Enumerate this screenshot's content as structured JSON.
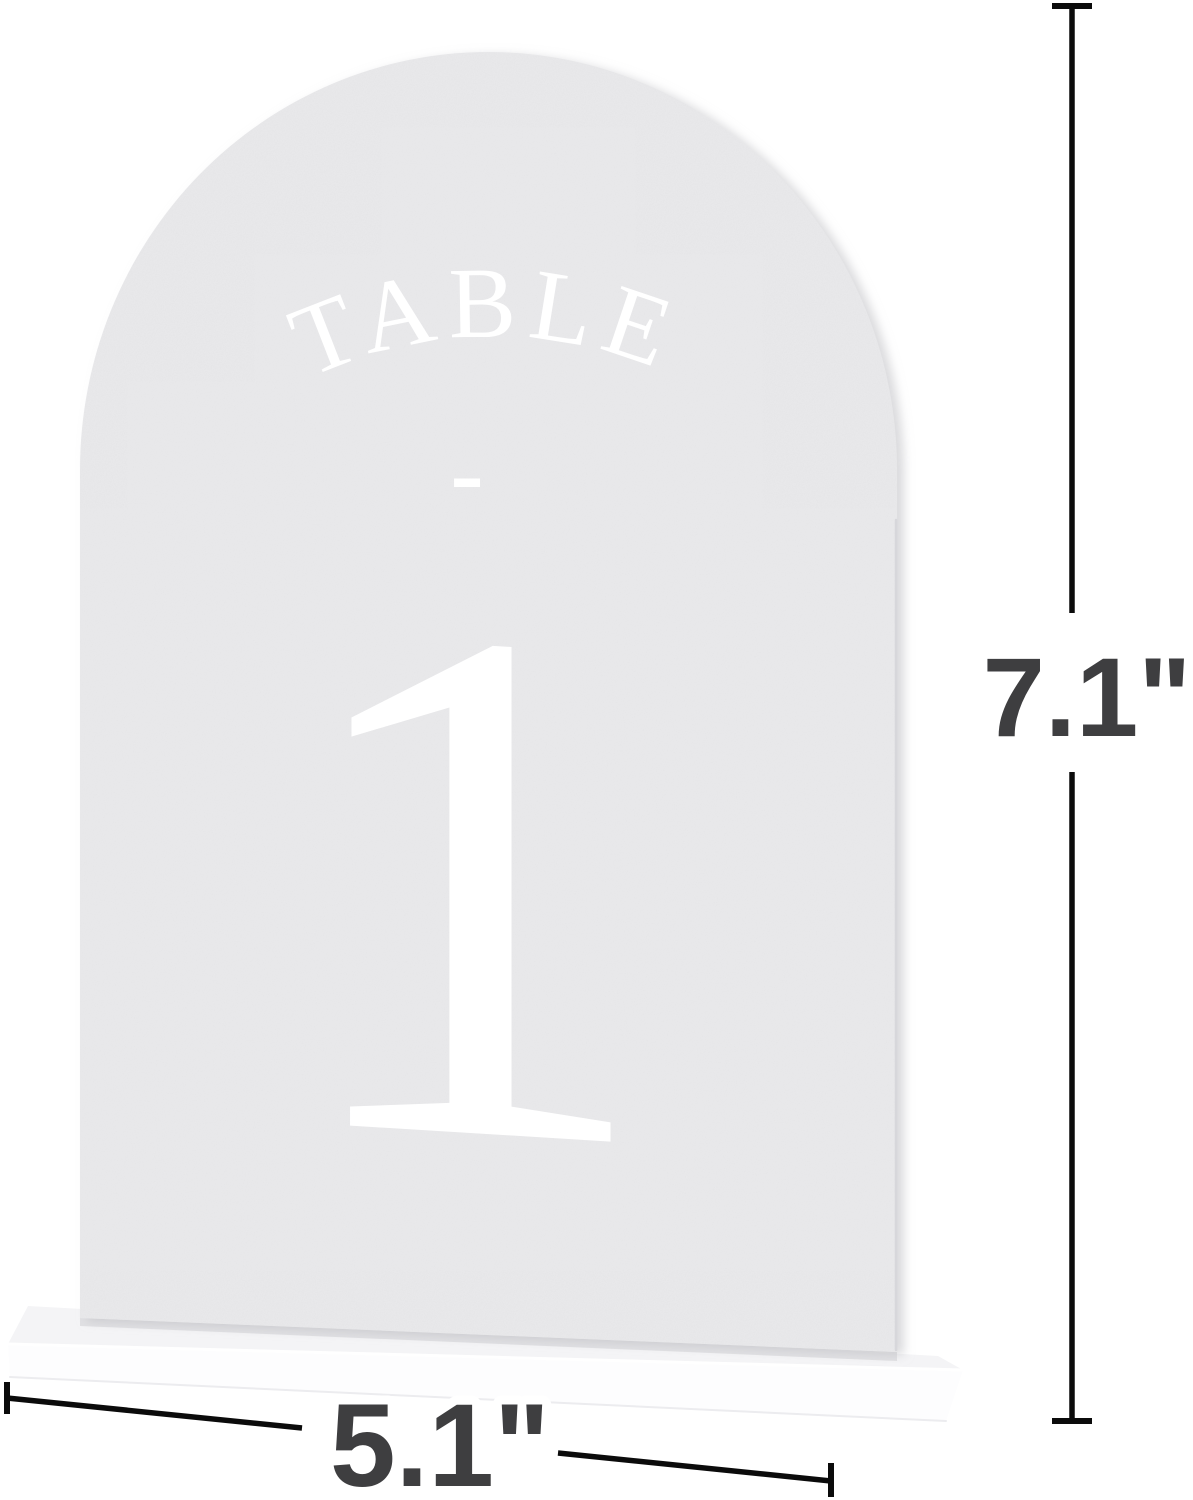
{
  "sign": {
    "arc_label": "TABLE",
    "divider": "-",
    "number": "1"
  },
  "dimensions": {
    "height_label": "7.1\"",
    "width_label": "5.1\""
  },
  "colors": {
    "background": "#ffffff",
    "sign_panel": "#e9e9eb",
    "sign_text": "#ffffff",
    "base_top": "#f4f4f6",
    "base_front": "#fdfdfe",
    "dimension_line": "#0b0b0b",
    "dimension_label": "#3e3e40"
  }
}
